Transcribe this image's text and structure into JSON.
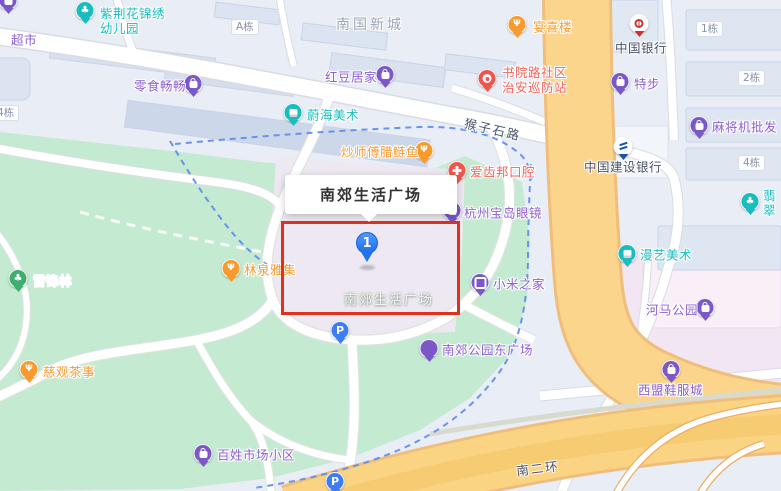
{
  "info_box": {
    "title": "南郊生活广场"
  },
  "marker": {
    "number": "1"
  },
  "map_label": "南郊生活广场",
  "colors": {
    "purple": "#7B57C8",
    "teal": "#1ABDBE",
    "orange": "#F79B2E",
    "red": "#F0544C",
    "green": "#3FAE6F",
    "blue": "#3D7CF4",
    "boc": "#CE342E",
    "ccb": "#1A56A8",
    "label_purple": "#8C5FD0",
    "label_teal": "#1ABDBE",
    "label_orange": "#F79B2E",
    "label_red": "#F2635B",
    "label_white": "#FFFFFF",
    "highlight": "#E0301E",
    "park": "#C5EAD2",
    "main_road": "#FBD58B",
    "commercial": "#F2E6F2"
  },
  "area_labels": [
    {
      "text": "南国新城",
      "x": 336,
      "y": 14
    }
  ],
  "road_labels": [
    {
      "text": "猴子石路",
      "x": 464,
      "y": 119,
      "rot": 13
    },
    {
      "text": "南二环",
      "x": 516,
      "y": 458,
      "rot": -7
    }
  ],
  "building_labels": [
    {
      "text": "A栋",
      "x": 231,
      "y": 19
    },
    {
      "text": "1栋",
      "x": 696,
      "y": 21
    },
    {
      "text": "2栋",
      "x": 738,
      "y": 70
    },
    {
      "text": "4栋",
      "x": 738,
      "y": 155
    },
    {
      "text": "4栋",
      "x": -8,
      "y": 105
    }
  ],
  "pois": [
    {
      "name": "supermarket",
      "label": "超市",
      "cat": "purple",
      "icon": "bag",
      "px": 8,
      "py": 2,
      "lx": 11,
      "ly": 40
    },
    {
      "name": "zijinghua-kindergarten",
      "label": "紫荆花锦绣\n幼儿园",
      "cat": "teal",
      "icon": "tree",
      "px": 85,
      "py": 12,
      "lx": 100,
      "ly": 21
    },
    {
      "name": "lingshi-changchang",
      "label": "零食畅畅",
      "cat": "purple",
      "icon": "bag",
      "px": 193,
      "py": 85,
      "lx": 134,
      "ly": 86
    },
    {
      "name": "hongdou-home",
      "label": "红豆居家",
      "cat": "purple",
      "icon": "bag",
      "px": 385,
      "py": 76,
      "lx": 325,
      "ly": 77
    },
    {
      "name": "yanxilou",
      "label": "宴喜楼",
      "cat": "orange",
      "icon": "fork",
      "px": 517,
      "py": 26,
      "lx": 533,
      "ly": 27
    },
    {
      "name": "bank-of-china",
      "label": "中国银行",
      "cat": "boc",
      "icon": "boc",
      "px": 639,
      "py": 25,
      "lx": 615,
      "ly": 48,
      "lcolor": "#49526A"
    },
    {
      "name": "weihai-art",
      "label": "蔚海美术",
      "cat": "teal",
      "icon": "book",
      "px": 293,
      "py": 114,
      "lx": 307,
      "ly": 115
    },
    {
      "name": "chaoshifu-lalianyu",
      "label": "炒师傅腊鲢鱼",
      "cat": "orange",
      "icon": "fork",
      "px": 424,
      "py": 152,
      "lx": 341,
      "ly": 152
    },
    {
      "name": "shuyuan-patrol-station",
      "label": "书院路社区\n治安巡防站",
      "cat": "red",
      "icon": "badge",
      "px": 487,
      "py": 80,
      "lx": 502,
      "ly": 80
    },
    {
      "name": "xtep",
      "label": "特步",
      "cat": "purple",
      "icon": "bag",
      "px": 620,
      "py": 83,
      "lx": 634,
      "ly": 84
    },
    {
      "name": "mahjong-wholesale",
      "label": "麻将机批发",
      "cat": "purple",
      "icon": "bag",
      "px": 699,
      "py": 127,
      "lx": 712,
      "ly": 127
    },
    {
      "name": "ccb-bank",
      "label": "中国建设银行",
      "cat": "ccb",
      "icon": "ccb",
      "px": 623,
      "py": 148,
      "lx": 584,
      "ly": 167,
      "lcolor": "#49526A"
    },
    {
      "name": "aichibang-dental",
      "label": "爱齿邦口腔",
      "cat": "red",
      "icon": "cross",
      "px": 457,
      "py": 172,
      "lx": 470,
      "ly": 172
    },
    {
      "name": "baodao-glasses",
      "label": "杭州宝岛眼镜",
      "cat": "purple",
      "icon": "bag",
      "px": 452,
      "py": 212,
      "lx": 464,
      "ly": 213
    },
    {
      "name": "feicui",
      "label": "翡翠",
      "cat": "teal",
      "icon": "tree",
      "px": 750,
      "py": 203,
      "lx": 763,
      "ly": 203
    },
    {
      "name": "manyi-art",
      "label": "漫艺美术",
      "cat": "teal",
      "icon": "book",
      "px": 627,
      "py": 255,
      "lx": 640,
      "ly": 255
    },
    {
      "name": "mi-home",
      "label": "小米之家",
      "cat": "purple",
      "icon": "square",
      "px": 480,
      "py": 284,
      "lx": 493,
      "ly": 284
    },
    {
      "name": "linquan-yaji",
      "label": "林泉雅集",
      "cat": "orange",
      "icon": "fork",
      "px": 231,
      "py": 270,
      "lx": 244,
      "ly": 270
    },
    {
      "name": "leifeng-forest",
      "label": "雷锋林",
      "cat": "green",
      "icon": "tree",
      "px": 18,
      "py": 280,
      "lx": 33,
      "ly": 281,
      "lcolor": "#FFFFFF"
    },
    {
      "name": "hema-park",
      "label": "河马公园",
      "cat": "purple",
      "icon": "bag",
      "px": 705,
      "py": 309,
      "lx": 646,
      "ly": 310
    },
    {
      "name": "ciguan-tea",
      "label": "慈观茶事",
      "cat": "orange",
      "icon": "fork",
      "px": 29,
      "py": 371,
      "lx": 43,
      "ly": 372
    },
    {
      "name": "parking-plaza",
      "label": "",
      "cat": "blue",
      "icon": "p",
      "px": 340,
      "py": 332,
      "lx": 0,
      "ly": 0
    },
    {
      "name": "nanjiao-park-east-square",
      "label": "南郊公园东广场",
      "cat": "purple",
      "icon": "pavilion",
      "px": 429,
      "py": 350,
      "lx": 442,
      "ly": 350
    },
    {
      "name": "ximeng-shoes-city",
      "label": "西盟鞋服城",
      "cat": "purple",
      "icon": "bag",
      "px": 671,
      "py": 371,
      "lx": 638,
      "ly": 390
    },
    {
      "name": "baixing-market-estate",
      "label": "百姓市场小区",
      "cat": "purple",
      "icon": "bag",
      "px": 203,
      "py": 455,
      "lx": 217,
      "ly": 455
    },
    {
      "name": "parking-south",
      "label": "",
      "cat": "blue",
      "icon": "p",
      "px": 335,
      "py": 483,
      "lx": 0,
      "ly": 0
    }
  ]
}
